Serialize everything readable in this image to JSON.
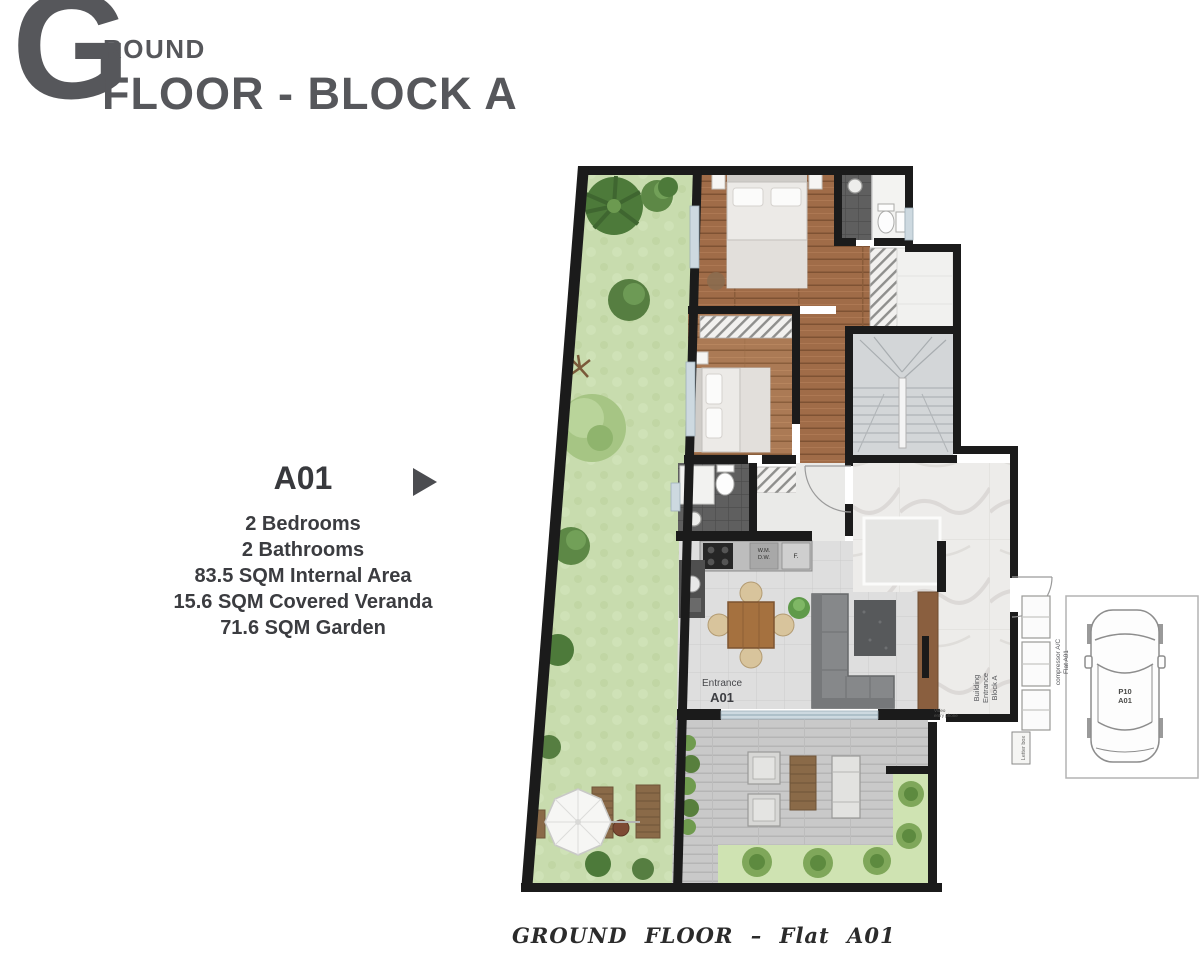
{
  "header": {
    "letter": "G",
    "letter_rest": "ROUND",
    "line2": "FLOOR - BLOCK A"
  },
  "unit": {
    "code": "A01",
    "specs": [
      "2 Bedrooms",
      "2 Bathrooms",
      "83.5 SQM Internal Area",
      "15.6 SQM Covered Veranda",
      "71.6 SQM Garden"
    ]
  },
  "caption": "GROUND FLOOR – Flat A01",
  "plan": {
    "entrance": [
      "Entrance",
      "A01"
    ],
    "building_entrance": [
      "Building",
      "Entrance",
      "Block A"
    ],
    "compressor": [
      "compressor A/C",
      "Flat A01"
    ],
    "letter_box": "Letter box",
    "video_entry": [
      "Video",
      "entry phone"
    ],
    "parking": [
      "P10",
      "A01"
    ],
    "kitchen": [
      "W.M.",
      "D.W.",
      "F."
    ]
  },
  "colors": {
    "title_gray": "#56575b",
    "info_text": "#3b3c40",
    "wall_black": "#1b1b1b",
    "grass_green": "#c8dcae",
    "wood_brown": "#a06c48",
    "tile_gray": "#dedede",
    "marble": "#edecea",
    "dark_tile": "#5f5f5f",
    "veranda_deck": "#c9c9c9",
    "veranda_green": "#cfe3b2"
  }
}
